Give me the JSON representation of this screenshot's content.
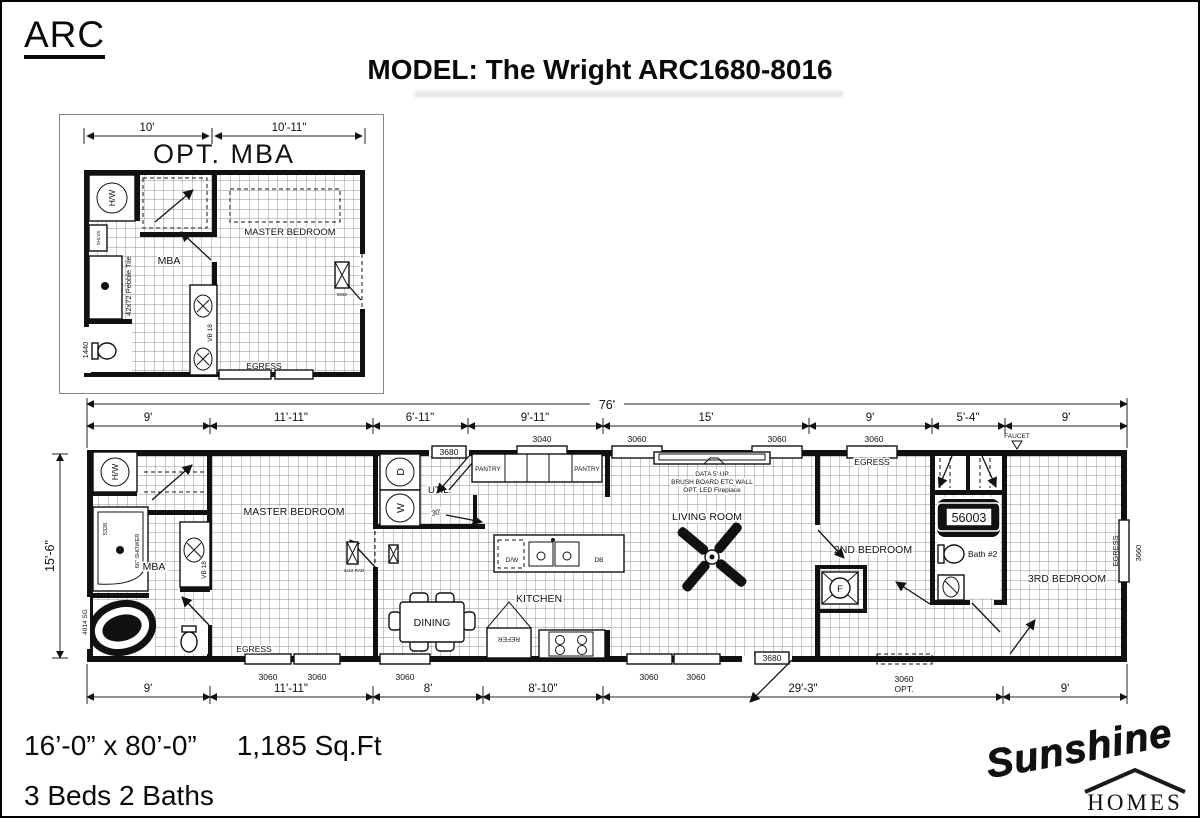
{
  "header": {
    "brand": "ARC",
    "title": "MODEL: The Wright ARC1680-8016"
  },
  "inset": {
    "title": "OPT. MBA",
    "dim_left": "10'",
    "dim_right": "10'-11\"",
    "master": "MASTER BEDROOM",
    "mba": "MBA",
    "hw": "H/W",
    "shlvs": "SHLVS",
    "pebble": "42x72 Pebble Tile",
    "vb": "VB 18",
    "toilet_code": "1440",
    "egress": "EGRESS",
    "window_code": "5032"
  },
  "plan": {
    "overall": "76'",
    "height": "15'-6\"",
    "top_dims": [
      "9'",
      "11'-11\"",
      "6'-11\"",
      "9'-11\"",
      "15'",
      "9'",
      "5'-4\"",
      "9'"
    ],
    "bottom_dims": [
      "9'",
      "11'-11\"",
      "8'",
      "8'-10\"",
      "29'-3\"",
      "9'"
    ],
    "windows_top": [
      "3680",
      "3040",
      "3060",
      "3060",
      "3060"
    ],
    "windows_bottom": [
      "3060",
      "3060",
      "3060",
      "3060",
      "3060",
      "3680",
      "3060"
    ],
    "rooms": {
      "master": "MASTER BEDROOM",
      "mba": "MBA",
      "util": "UTIL.",
      "pantry1": "PANTRY",
      "pantry2": "PANTRY",
      "kitchen": "KITCHEN",
      "dining": "DINING",
      "living": "LIVING ROOM",
      "bed2": "2ND BEDROOM",
      "bath2": "Bath #2",
      "bed3": "3RD BEDROOM"
    },
    "labels": {
      "hw": "H/W",
      "shower_code": "5328",
      "shower": "66\" SHOWER",
      "tub_code": "2207",
      "sg": "4014 SG",
      "vb": "VB 18",
      "dryer": "D",
      "washer": "W",
      "door30": "30'",
      "dw": "D/W",
      "db": "DB",
      "refer": "REFER",
      "furnace": "F",
      "rad": "1x12 RAD",
      "tub2_code": "56003",
      "fireplace1": "DATA 5' UP",
      "fireplace2": "BRUSH BOARD ETC WALL",
      "fireplace3": "OPT. LED Fireplace",
      "egress_master": "EGRESS",
      "egress_bed2": "EGRESS",
      "egress_right": "EGRESS",
      "faucet": "FAUCET",
      "window_right": "3660",
      "opt": "OPT."
    }
  },
  "footer": {
    "size": "16’-0” x 80’-0”",
    "sqft": "1,185 Sq.Ft",
    "beds": "3 Beds 2 Baths"
  },
  "logo": {
    "name": "Sunshine",
    "sub": "HOMES",
    "color": "#c5242b"
  }
}
